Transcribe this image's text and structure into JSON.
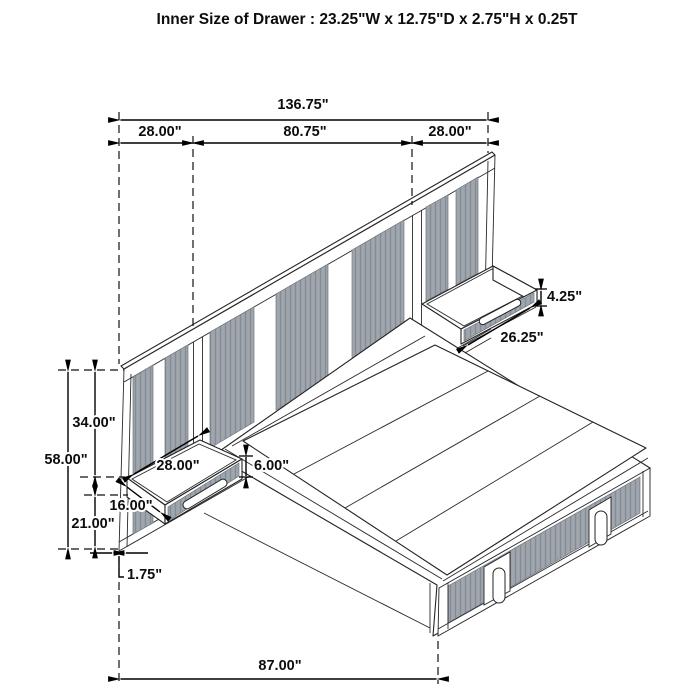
{
  "title": "Inner Size of Drawer : 23.25\"W x 12.75\"D x 2.75\"H x 0.25T",
  "colors": {
    "background": "#ffffff",
    "line": "#232323",
    "slat_gray": "#9aa1a9",
    "slat_line": "#848b93"
  },
  "drawing": {
    "description": "isometric dimension diagram of wall-panel storage bed with two floating nightstand drawers"
  },
  "dims": {
    "total_width": "136.75\"",
    "left_section_width": "28.00\"",
    "center_section_width": "80.75\"",
    "right_section_width": "28.00\"",
    "right_drawer_front_height": "4.25\"",
    "right_drawer_width": "26.25\"",
    "panel_top_to_drawer": "34.00\"",
    "panel_height": "58.00\"",
    "left_drawer_width": "28.00\"",
    "left_drawer_front_height": "6.00\"",
    "left_drawer_depth": "16.00\"",
    "drawer_to_floor": "21.00\"",
    "panel_thickness": "1.75\"",
    "bed_length": "87.00\""
  }
}
